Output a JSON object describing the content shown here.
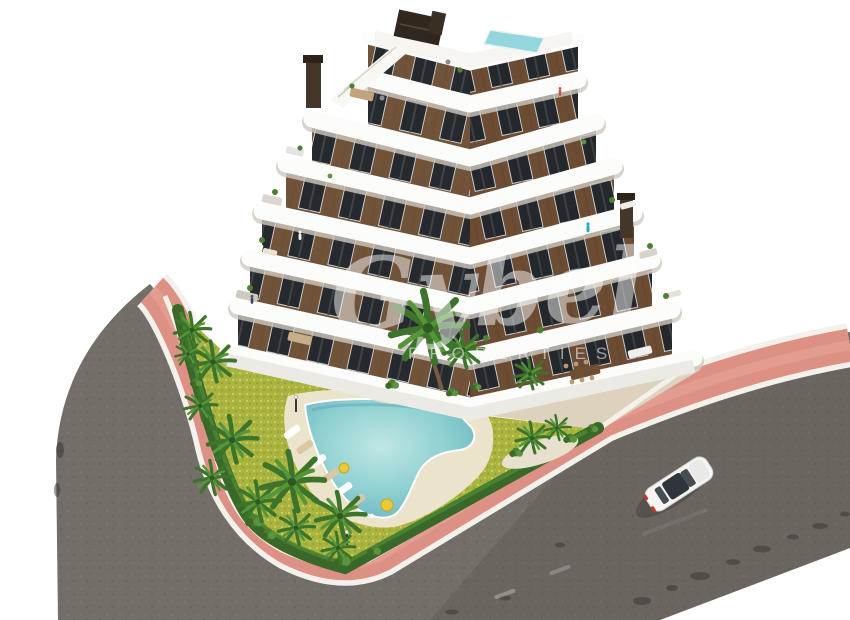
{
  "scene": {
    "title": "Aerial 3D render of a residential apartment complex with communal pool and garden",
    "watermark": {
      "script": "Gybel",
      "caption": "PROPERTIES"
    },
    "building": {
      "floors_visible": 7,
      "facade_color": "#6d5137",
      "balcony_band_color": "#fcfcfb",
      "window_color": "#26292d",
      "rooftop_pool_color": "#93d6de",
      "has_rooftop_terrace": true,
      "chimneys": 3
    },
    "garden": {
      "lawn_color": "#a9b340",
      "hedge_color": "#3a682a",
      "pool_color": "#8cd0d3",
      "pool_shape": "boomerang",
      "beach_deck_color": "#ece3cb",
      "palm_trees": 18,
      "sun_loungers": 6,
      "parasols": 2,
      "lamp_posts": 2
    },
    "streets": {
      "asphalt_color": "#746e68",
      "sidewalk_color": "#dc9184",
      "curb_color": "#f4f1ec",
      "vehicles": [
        {
          "type": "car",
          "color": "#f5f5f3",
          "location": "right road"
        }
      ]
    },
    "background_color": "#ffffff"
  }
}
